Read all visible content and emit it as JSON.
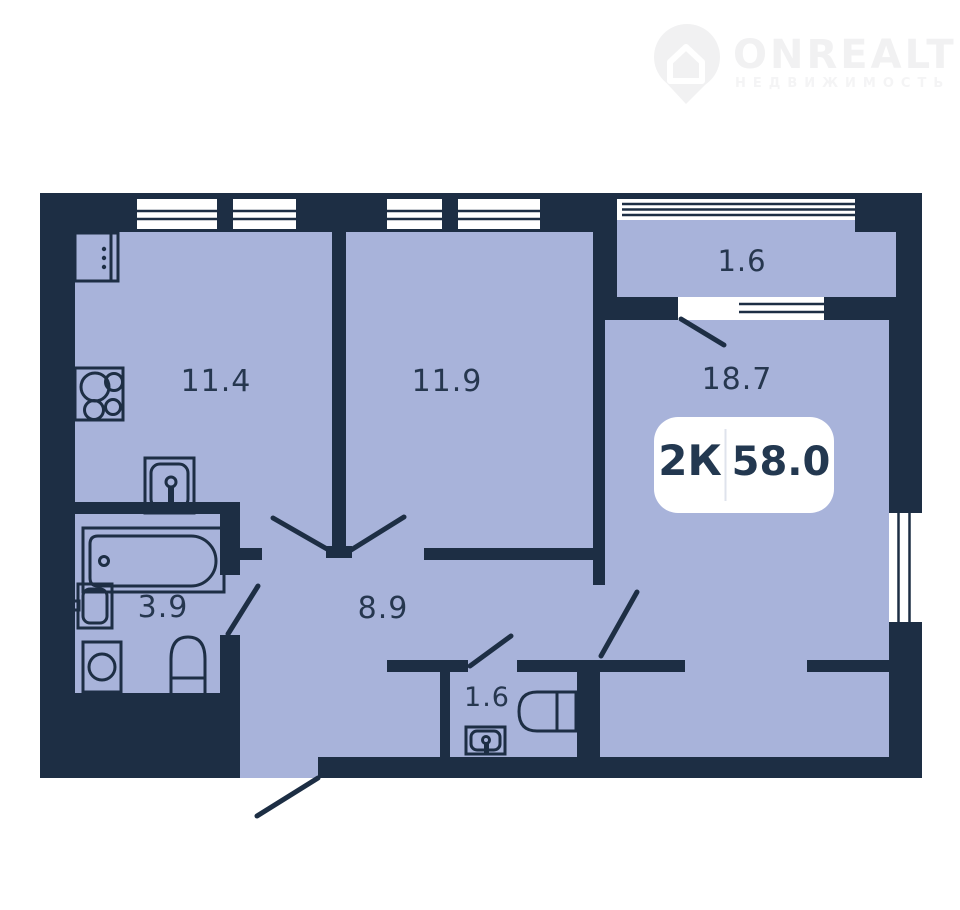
{
  "logo": {
    "brand": "ONREALT",
    "tagline": "НЕДВИЖИМОСТЬ"
  },
  "badge": {
    "rooms_label": "2К",
    "area_value": "58.0"
  },
  "rooms": [
    {
      "name": "kitchen",
      "area": "11.4"
    },
    {
      "name": "bedroom",
      "area": "11.9"
    },
    {
      "name": "living-room",
      "area": "18.7"
    },
    {
      "name": "balcony",
      "area": "1.6"
    },
    {
      "name": "bathroom",
      "area": "3.9"
    },
    {
      "name": "hallway",
      "area": "8.9"
    },
    {
      "name": "wc",
      "area": "1.6"
    }
  ],
  "colors": {
    "wall": "#1d2e44",
    "floor": "#a8b3da",
    "background": "#ffffff",
    "label": "#26374f",
    "badge_text": "#233850",
    "badge_divider": "#dfe3ec",
    "logo": "#f1f1f2",
    "logo_sub": "#f4f4f5"
  }
}
